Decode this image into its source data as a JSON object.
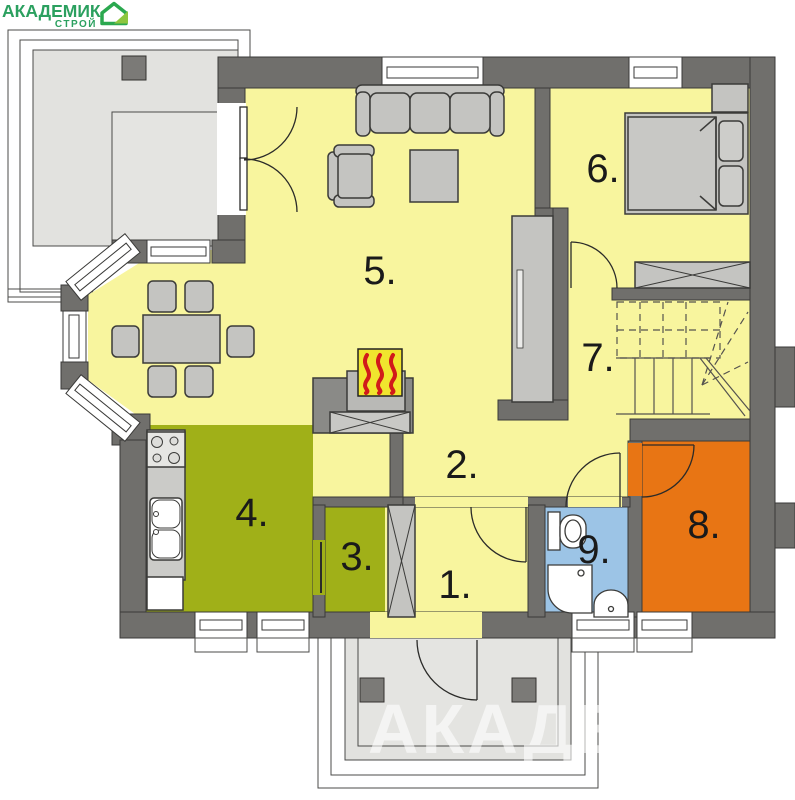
{
  "logo": {
    "brand": "АКАДЕМИК",
    "sub": "СТРОЙ",
    "color": "#2BA05F",
    "icon": "house-icon",
    "icon_accent": "#8DC63F"
  },
  "watermark": {
    "text": "АКАДЕМИК"
  },
  "palette": {
    "background": "#FFFFFF",
    "wall": "#706F6C",
    "outline": "#3A3A38",
    "floor_yellow": "#F8F59E",
    "room_green": "#A0B018",
    "room_orange": "#E87514",
    "room_blue": "#9CC4E6",
    "terrace_gray": "#E2E2DF",
    "furniture_gray": "#C4C4C1",
    "pillar_gray": "#7B7A77",
    "fireplace_yellow": "#F0E52E",
    "fireplace_red": "#D11A1A"
  },
  "rooms": [
    {
      "num": "1.",
      "color": "#F8F59E"
    },
    {
      "num": "2.",
      "color": "#F8F59E"
    },
    {
      "num": "3.",
      "color": "#A0B018"
    },
    {
      "num": "4.",
      "color": "#A0B018"
    },
    {
      "num": "5.",
      "color": "#F8F59E"
    },
    {
      "num": "6.",
      "color": "#F8F59E"
    },
    {
      "num": "7.",
      "color": "#F8F59E"
    },
    {
      "num": "8.",
      "color": "#E87514"
    },
    {
      "num": "9.",
      "color": "#9CC4E6"
    }
  ]
}
